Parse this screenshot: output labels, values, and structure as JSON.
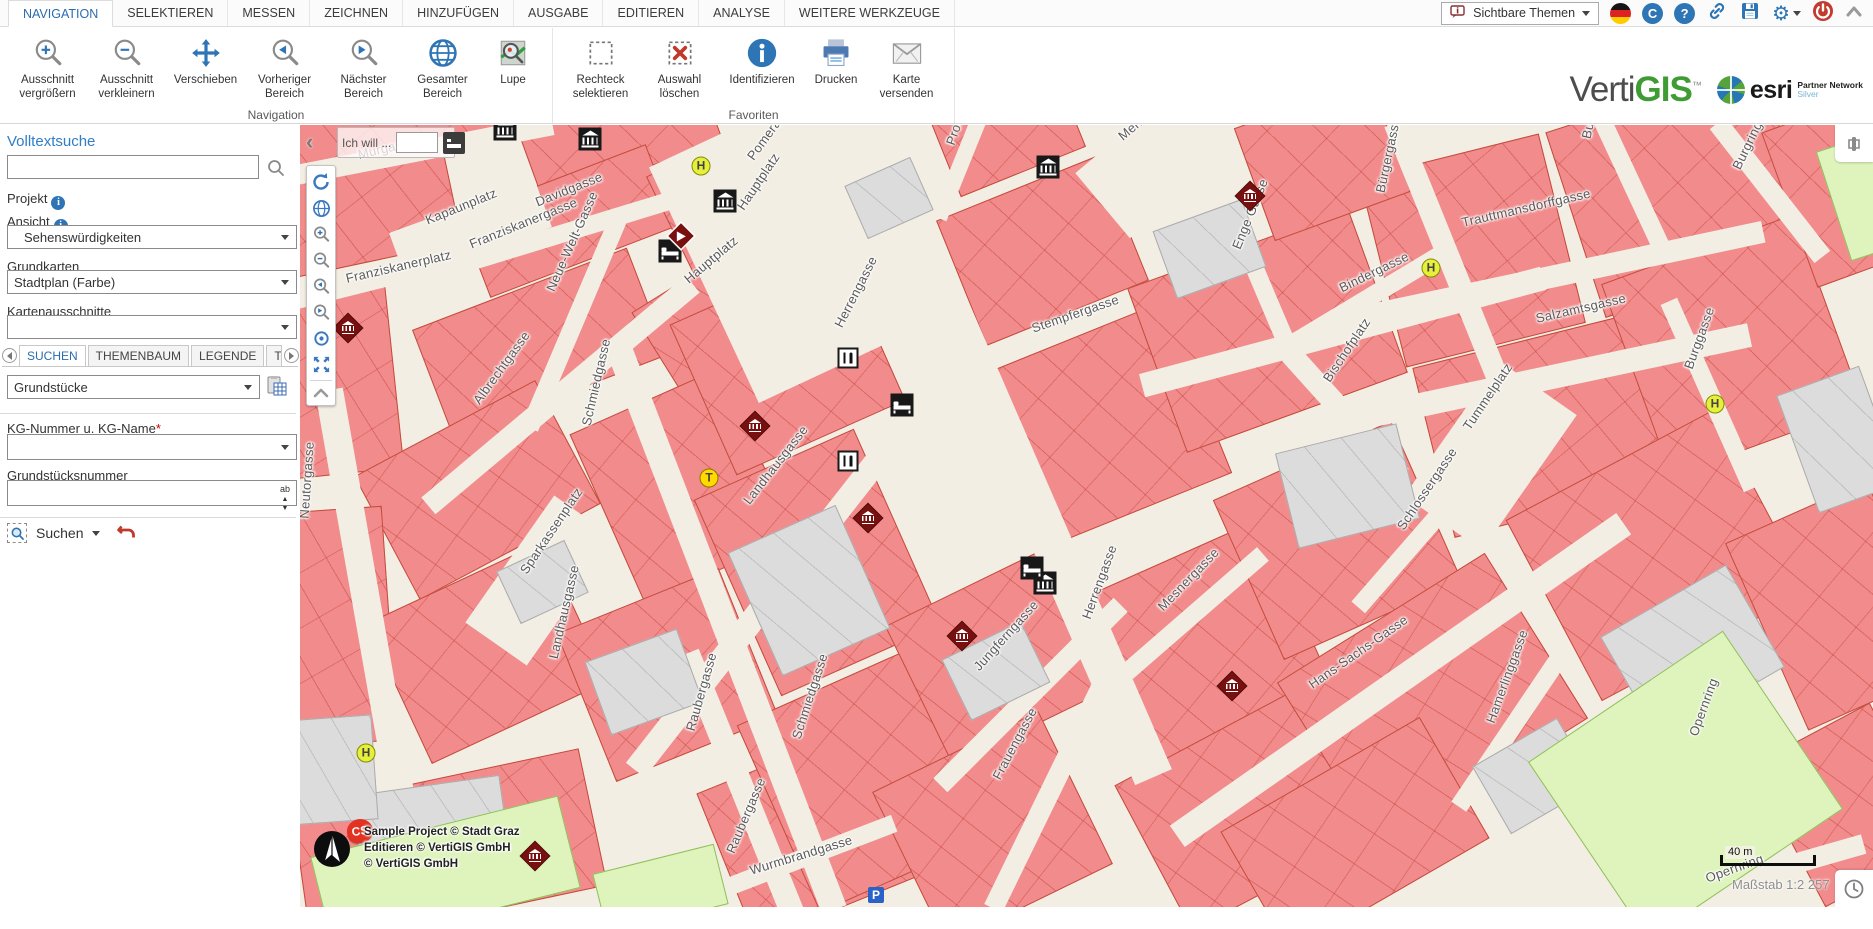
{
  "ribbon": {
    "tabs": [
      {
        "label": "NAVIGATION",
        "active": true
      },
      {
        "label": "SELEKTIEREN"
      },
      {
        "label": "MESSEN"
      },
      {
        "label": "ZEICHNEN"
      },
      {
        "label": "HINZUFÜGEN"
      },
      {
        "label": "AUSGABE"
      },
      {
        "label": "EDITIEREN"
      },
      {
        "label": "ANALYSE"
      },
      {
        "label": "WEITERE WERKZEUGE"
      }
    ],
    "visible_themes_label": "Sichtbare Themen"
  },
  "toolbar": {
    "groups": [
      {
        "label": "Navigation",
        "buttons": [
          {
            "label": "Ausschnitt vergrößern"
          },
          {
            "label": "Ausschnitt verkleinern"
          },
          {
            "label": "Verschieben"
          },
          {
            "label": "Vorheriger Bereich"
          },
          {
            "label": "Nächster Bereich"
          },
          {
            "label": "Gesamter Bereich"
          },
          {
            "label": "Lupe"
          }
        ]
      },
      {
        "label": "Favoriten",
        "buttons": [
          {
            "label": "Rechteck selektieren"
          },
          {
            "label": "Auswahl löschen"
          },
          {
            "label": "Identifizieren"
          },
          {
            "label": "Drucken"
          },
          {
            "label": "Karte versenden"
          }
        ]
      }
    ]
  },
  "brand": {
    "vertigis_verti": "Verti",
    "vertigis_gis": "GIS",
    "tm": "™",
    "esri": "esri",
    "partner_line1": "Partner Network",
    "partner_line2": "Silver"
  },
  "sidebar": {
    "fulltext_heading": "Volltextsuche",
    "fulltext_value": "",
    "project_label": "Projekt",
    "view_label": "Ansicht",
    "view_value": "Sehenswürdigkeiten",
    "basemap_label": "Grundkarten",
    "basemap_value": "Stadtplan (Farbe)",
    "extent_label": "Kartenausschnitte",
    "extent_value": "",
    "tabs": [
      {
        "label": "SUCHEN",
        "active": true
      },
      {
        "label": "THEMENBAUM"
      },
      {
        "label": "LEGENDE"
      },
      {
        "label": "THEMEN"
      }
    ],
    "search_theme_value": "Grundstücke",
    "kg_label": "KG-Nummer u. KG-Name",
    "required_mark": "*",
    "kg_value": "",
    "parcel_label": "Grundstücksnummer",
    "parcel_value": "",
    "ab_icon_text": "ab",
    "search_button_label": "Suchen"
  },
  "map": {
    "ich_will_label": "Ich will ...",
    "ich_will_value": "",
    "attribution": [
      "Sample Project © Stadt Graz",
      "Editieren © VertiGIS GmbH",
      "© VertiGIS GmbH"
    ],
    "cs_badge": "CS",
    "scale_bar_label": "40 m",
    "scale_text": "Maßstab 1:2 257",
    "labels": [
      [
        "Murgasse",
        58,
        22,
        -13
      ],
      [
        "Kapaunplatz",
        126,
        88,
        -22
      ],
      [
        "Davidgasse",
        236,
        70,
        -22
      ],
      [
        "Franziskanergasse",
        170,
        112,
        -22
      ],
      [
        "Franziskanerplatz",
        46,
        146,
        -13
      ],
      [
        "Neue-Welt-Gasse",
        250,
        158,
        -66
      ],
      [
        "Pomeranzengasse",
        450,
        26,
        -54
      ],
      [
        "Prokopigasse",
        650,
        12,
        -71
      ],
      [
        "Mehlplatz",
        820,
        5,
        -40
      ],
      [
        "Hauptplatz",
        440,
        76,
        -56
      ],
      [
        "Hauptplatz",
        386,
        148,
        -40
      ],
      [
        "Herrengasse",
        538,
        194,
        -63
      ],
      [
        "Stempfergasse",
        732,
        196,
        -19
      ],
      [
        "Enge Gasse",
        936,
        116,
        -68
      ],
      [
        "Bürgergasse",
        1080,
        60,
        -78
      ],
      [
        "Burggasse",
        1286,
        6,
        -78
      ],
      [
        "Trauttmansdorffgasse",
        1162,
        90,
        -13
      ],
      [
        "Bindergasse",
        1040,
        156,
        -26
      ],
      [
        "Salzamtsgasse",
        1236,
        186,
        -13
      ],
      [
        "Burgring",
        1436,
        36,
        -64
      ],
      [
        "Bischofplatz",
        1026,
        248,
        -56
      ],
      [
        "Tummelplatz",
        1166,
        296,
        -56
      ],
      [
        "Burggasse",
        1388,
        236,
        -70
      ],
      [
        "Schlossergasse",
        1100,
        396,
        -56
      ],
      [
        "Mesnergasse",
        860,
        476,
        -46
      ],
      [
        "Hans-Sachs-Gasse",
        1010,
        553,
        -35
      ],
      [
        "Herrengasse",
        786,
        486,
        -70
      ],
      [
        "Jungferngasse",
        676,
        536,
        -48
      ],
      [
        "Frauengasse",
        696,
        646,
        -62
      ],
      [
        "Hamerlinggasse",
        1190,
        590,
        -70
      ],
      [
        "Opernring",
        1393,
        603,
        -70
      ],
      [
        "Opernring",
        1406,
        746,
        -20
      ],
      [
        "Wurmbrandgasse",
        450,
        738,
        -17
      ],
      [
        "Raubergasse",
        390,
        598,
        -74
      ],
      [
        "Raubergasse",
        430,
        720,
        -67
      ],
      [
        "Schmiedgasse",
        286,
        293,
        -77
      ],
      [
        "Schmiedgasse",
        496,
        606,
        -72
      ],
      [
        "Landhausgasse",
        446,
        370,
        -52
      ],
      [
        "Landhausgasse",
        253,
        526,
        -77
      ],
      [
        "Albrechtgasse",
        176,
        270,
        -54
      ],
      [
        "Sparkassenplatz",
        223,
        440,
        -56
      ],
      [
        "Neutorgasse",
        4,
        386,
        -86
      ]
    ],
    "roads": [
      [
        710,
        322,
        720,
        40,
        66.5
      ],
      [
        425,
        500,
        610,
        26,
        69
      ],
      [
        440,
        658,
        280,
        24,
        68
      ],
      [
        75,
        526,
        530,
        28,
        80
      ],
      [
        480,
        460,
        470,
        24,
        -52
      ],
      [
        260,
        270,
        345,
        22,
        -40
      ],
      [
        1042,
        207,
        415,
        24,
        -15
      ],
      [
        1250,
        152,
        435,
        22,
        -12
      ],
      [
        1205,
        262,
        500,
        24,
        -12
      ],
      [
        730,
        570,
        255,
        20,
        -45
      ],
      [
        748,
        671,
        250,
        20,
        -64
      ],
      [
        498,
        735,
        205,
        18,
        -21
      ],
      [
        895,
        488,
        180,
        18,
        -41
      ],
      [
        1100,
        555,
        545,
        26,
        -35
      ],
      [
        1125,
        405,
        205,
        18,
        -49
      ],
      [
        1162,
        165,
        360,
        22,
        68
      ],
      [
        1070,
        172,
        170,
        18,
        -31
      ],
      [
        952,
        138,
        175,
        18,
        67
      ],
      [
        1045,
        290,
        165,
        22,
        48
      ],
      [
        1330,
        55,
        150,
        18,
        65
      ],
      [
        1410,
        270,
        205,
        18,
        66
      ],
      [
        1470,
        65,
        170,
        20,
        52
      ],
      [
        1210,
        605,
        185,
        18,
        -56
      ],
      [
        1410,
        620,
        195,
        22,
        -58
      ],
      [
        1455,
        750,
        225,
        20,
        -16
      ],
      [
        125,
        25,
        260,
        20,
        -11
      ],
      [
        290,
        100,
        275,
        18,
        -17
      ],
      [
        275,
        195,
        235,
        18,
        -67
      ],
      [
        100,
        145,
        215,
        26,
        -14
      ],
      [
        480,
        60,
        160,
        16,
        -50
      ],
      [
        660,
        40,
        115,
        16,
        -68
      ],
      [
        490,
        120,
        260,
        190,
        65
      ],
      [
        1190,
        330,
        165,
        95,
        -55
      ],
      [
        850,
        40,
        125,
        85,
        -40
      ],
      [
        240,
        455,
        155,
        75,
        -55
      ],
      [
        170,
        105,
        155,
        50,
        -20
      ]
    ],
    "blocks": [
      [
        -30,
        -35,
        240,
        75,
        -13
      ],
      [
        225,
        -30,
        190,
        80,
        -20
      ],
      [
        -25,
        42,
        180,
        95,
        -12
      ],
      [
        168,
        52,
        200,
        88,
        -21
      ],
      [
        368,
        12,
        150,
        135,
        -26
      ],
      [
        125,
        160,
        230,
        115,
        -21
      ],
      [
        -35,
        165,
        130,
        185,
        -6
      ],
      [
        355,
        145,
        125,
        125,
        -32
      ],
      [
        75,
        295,
        205,
        140,
        -28
      ],
      [
        -40,
        385,
        130,
        235,
        -4
      ],
      [
        90,
        450,
        195,
        155,
        -25
      ],
      [
        300,
        268,
        165,
        185,
        -24
      ],
      [
        280,
        470,
        175,
        160,
        -22
      ],
      [
        120,
        640,
        175,
        140,
        -12
      ],
      [
        420,
        630,
        175,
        160,
        -22
      ],
      [
        0,
        688,
        115,
        100,
        -8
      ],
      [
        395,
        155,
        185,
        165,
        -24
      ],
      [
        430,
        330,
        175,
        215,
        -24
      ],
      [
        470,
        552,
        195,
        205,
        -24
      ],
      [
        655,
        58,
        175,
        135,
        -22
      ],
      [
        700,
        208,
        205,
        185,
        -22
      ],
      [
        610,
        455,
        175,
        155,
        -26
      ],
      [
        600,
        618,
        185,
        170,
        -26
      ],
      [
        800,
        428,
        205,
        185,
        -24
      ],
      [
        840,
        598,
        225,
        165,
        -28
      ],
      [
        850,
        118,
        235,
        175,
        -20
      ],
      [
        1080,
        28,
        185,
        195,
        -14
      ],
      [
        1270,
        -32,
        225,
        195,
        -18
      ],
      [
        1130,
        212,
        235,
        175,
        -14
      ],
      [
        1330,
        118,
        205,
        205,
        -20
      ],
      [
        1240,
        328,
        235,
        205,
        -28
      ],
      [
        1460,
        378,
        155,
        205,
        -24
      ],
      [
        940,
        328,
        195,
        175,
        -24
      ],
      [
        1010,
        478,
        245,
        195,
        -32
      ],
      [
        1280,
        558,
        205,
        165,
        -30
      ],
      [
        1485,
        -22,
        145,
        165,
        -20
      ],
      [
        940,
        640,
        230,
        140,
        -30
      ],
      [
        1480,
        600,
        135,
        160,
        -28
      ],
      [
        950,
        -25,
        145,
        120,
        -20
      ],
      [
        640,
        -35,
        135,
        85,
        -22
      ]
    ],
    "grays": [
      [
        450,
        398,
        118,
        135,
        -24
      ],
      [
        295,
        518,
        98,
        78,
        -20
      ],
      [
        985,
        312,
        125,
        98,
        -14
      ],
      [
        1320,
        468,
        145,
        118,
        -30
      ],
      [
        652,
        512,
        88,
        68,
        -26
      ],
      [
        55,
        660,
        150,
        72,
        -8
      ],
      [
        1185,
        612,
        98,
        78,
        -30
      ],
      [
        553,
        44,
        72,
        58,
        -24
      ],
      [
        -30,
        593,
        105,
        105,
        -4
      ],
      [
        1495,
        252,
        88,
        125,
        -20
      ],
      [
        862,
        88,
        95,
        72,
        -20
      ],
      [
        205,
        428,
        75,
        58,
        -25
      ]
    ],
    "greens": [
      [
        18,
        700,
        255,
        95,
        -14
      ],
      [
        1268,
        553,
        235,
        215,
        -34
      ],
      [
        1532,
        14,
        65,
        115,
        -18
      ],
      [
        298,
        733,
        125,
        62,
        -14
      ]
    ],
    "icons": [
      [
        "museum",
        205,
        4
      ],
      [
        "museum",
        290,
        14
      ],
      [
        "museum",
        425,
        76
      ],
      [
        "museum",
        748,
        42
      ],
      [
        "museum",
        745,
        458
      ],
      [
        "hotel",
        370,
        126
      ],
      [
        "hotel",
        602,
        280
      ],
      [
        "hotel",
        732,
        443
      ],
      [
        "restaurant",
        548,
        233
      ],
      [
        "restaurant",
        548,
        336
      ],
      [
        "museum_red",
        48,
        203
      ],
      [
        "museum_red",
        455,
        301
      ],
      [
        "museum_red",
        568,
        393
      ],
      [
        "museum_red",
        662,
        511
      ],
      [
        "museum_red",
        932,
        561
      ],
      [
        "museum_red",
        950,
        71
      ],
      [
        "museum_red",
        235,
        731
      ],
      [
        "marker",
        381,
        111
      ],
      [
        "stop_h",
        401,
        41
      ],
      [
        "stop_h",
        1131,
        143
      ],
      [
        "stop_h",
        1415,
        279
      ],
      [
        "stop_h",
        66,
        628
      ],
      [
        "stop_t",
        409,
        353
      ],
      [
        "parking",
        576,
        770
      ]
    ]
  },
  "colors": {
    "accent": "#2e75b6",
    "tab_active": "#2b6cb0",
    "building_fill": "#f28c8c",
    "building_line": "#c44b3c",
    "street_fill": "#f2eee3",
    "gray_fill": "#dcdcdc",
    "green_fill": "#def4bc",
    "museum_red": "#78100f",
    "stop_yellow": "#e7ef3d",
    "danger_red": "#c0392b"
  }
}
